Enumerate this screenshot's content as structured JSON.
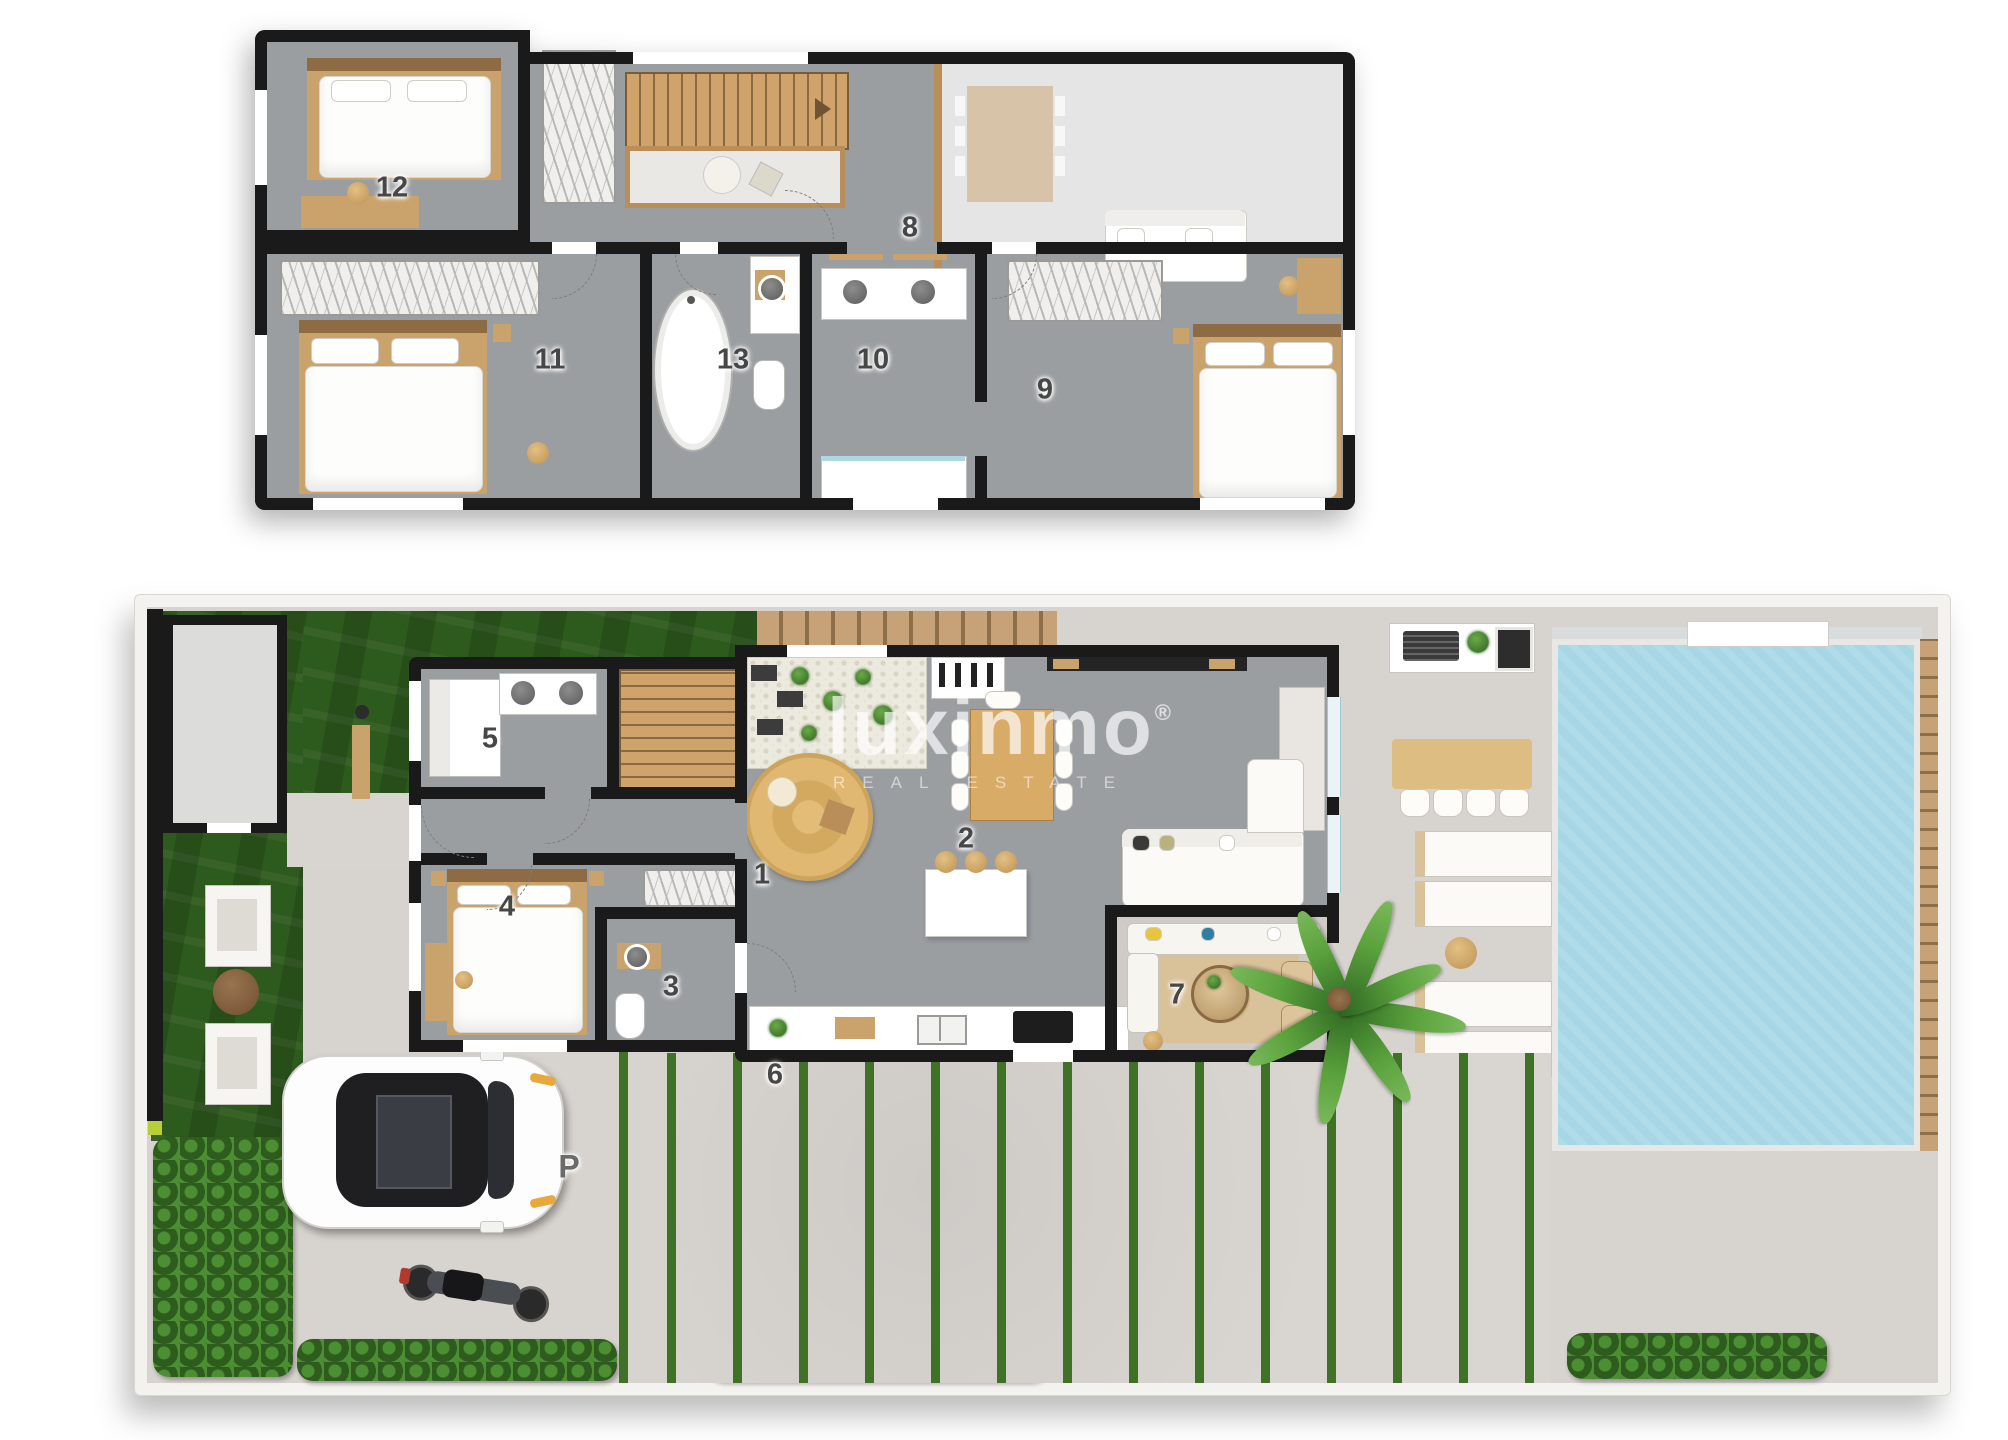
{
  "watermark": {
    "brand": "luxinmo",
    "registered": "®",
    "tagline": "REAL ESTATE"
  },
  "palette": {
    "wall": "#1a1a1a",
    "floor": "#9b9ea1",
    "floor_light": "#e4e5e4",
    "wood": "#c9a36b",
    "wood_dark": "#8f6b43",
    "lawn": "#2d5a1d",
    "hedge": "#47832f",
    "pool": "#a7d7e7",
    "paving": "#d7d3cf",
    "terrace": "#cfcbc7",
    "accent_yellow": "#e9c53f",
    "accent_blue": "#2e7fa3"
  },
  "upper_floor": {
    "rooms": {
      "r8": "8",
      "r9": "9",
      "r10": "10",
      "r11": "11",
      "r12": "12",
      "r13": "13"
    }
  },
  "ground_floor": {
    "rooms": {
      "r1": "1",
      "r2": "2",
      "r3": "3",
      "r4": "4",
      "r5": "5",
      "r6": "6",
      "r7": "7"
    },
    "parking": "P"
  }
}
